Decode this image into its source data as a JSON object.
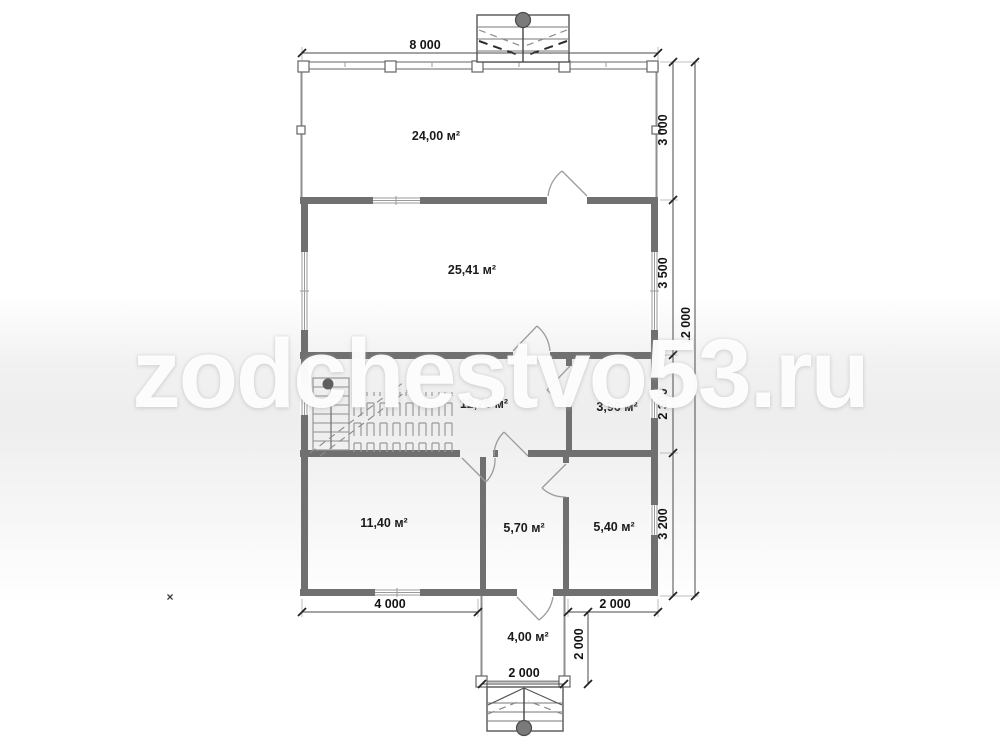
{
  "watermark": {
    "text": "zodchestvo53.ru"
  },
  "rooms": [
    "24,00 м²",
    "25,41 м²",
    "12,76 м²",
    "3,96 м²",
    "11,40 м²",
    "5,70 м²",
    "5,40 м²",
    "4,00 м²"
  ],
  "dimensions": {
    "top_width": "8 000",
    "right_segments": [
      "3 000",
      "3 500",
      "2 300",
      "3 200"
    ],
    "right_total": "12 000",
    "bottom_left": "4 000",
    "bottom_right": "2 000",
    "vestibule_width": "2 000",
    "vestibule_depth": "2 000"
  },
  "markers": {
    "cross": "×"
  },
  "colors": {
    "wall": "#707070",
    "dimension_text": "#141414",
    "watermark_band": "#e6e6e6"
  }
}
